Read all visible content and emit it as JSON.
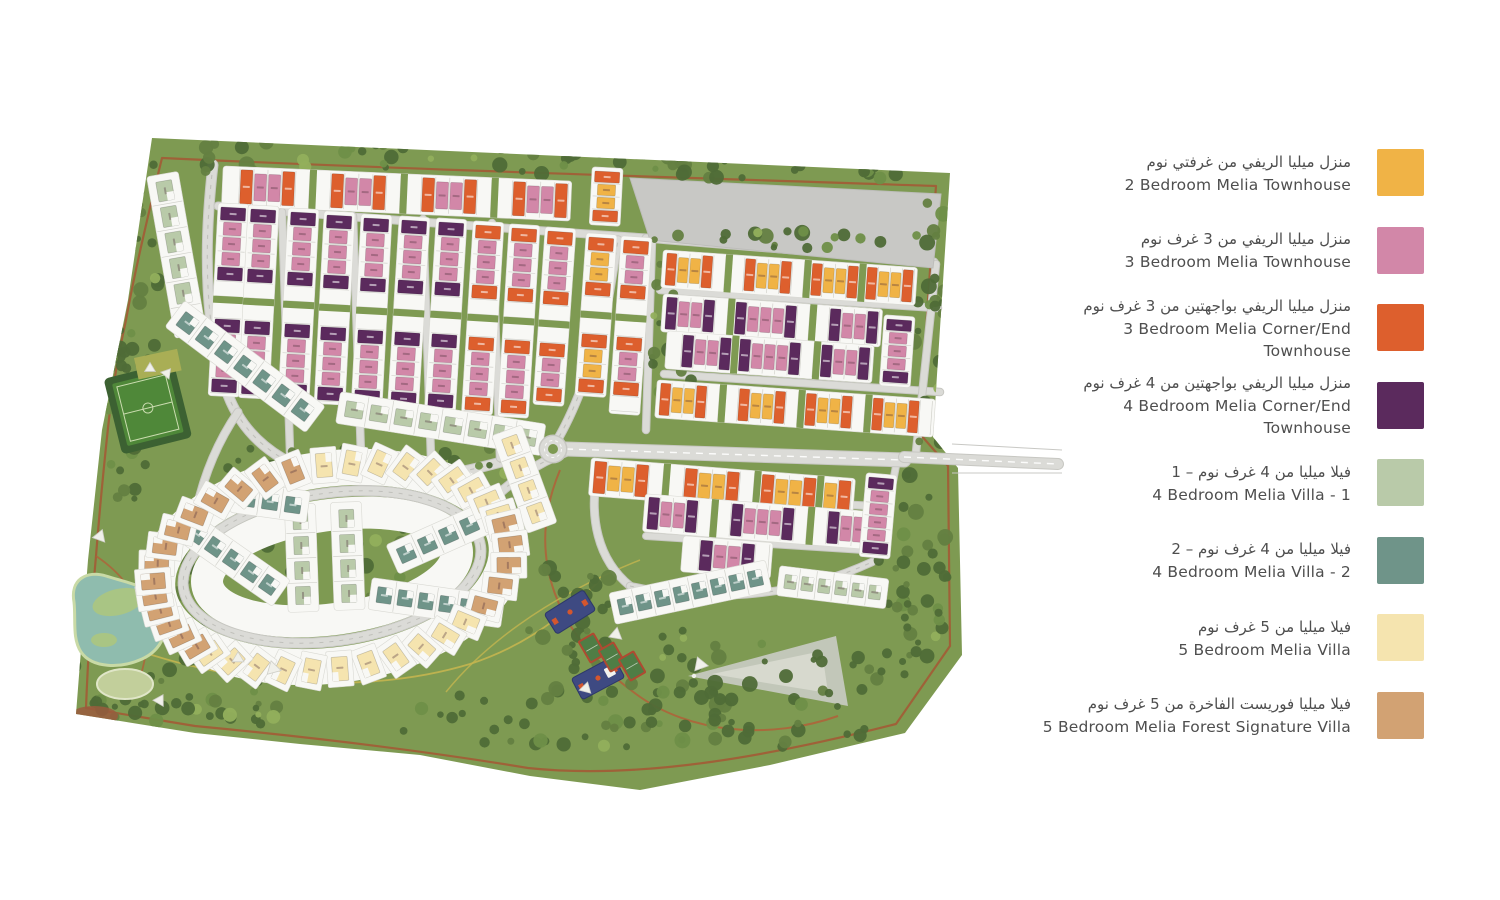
{
  "legend": {
    "items": [
      {
        "code": "Y",
        "ar": "منزل ميليا الريفي من غرفتي نوم",
        "en": "2 Bedroom Melia Townhouse",
        "color": "#F0B346"
      },
      {
        "code": "P",
        "ar": "منزل ميليا الريفي من 3 غرف نوم",
        "en": "3 Bedroom Melia Townhouse",
        "color": "#D287A8"
      },
      {
        "code": "O",
        "ar": "منزل ميليا الريفي بواجهتين من 3 غرف نوم",
        "en": "3 Bedroom Melia Corner/End Townhouse",
        "color": "#DD5F2D"
      },
      {
        "code": "U",
        "ar": "منزل ميليا الريفي بواجهتين من 4 غرف نوم",
        "en": "4 Bedroom Melia Corner/End Townhouse",
        "color": "#5B2A5D"
      },
      {
        "code": "G",
        "ar": "فيلا ميليا من 4 غرف نوم – 1",
        "en": "4 Bedroom Melia Villa - 1",
        "color": "#B9CAA9"
      },
      {
        "code": "T",
        "ar": "فيلا ميليا من 4 غرف نوم – 2",
        "en": "4 Bedroom Melia Villa - 2",
        "color": "#6F9489"
      },
      {
        "code": "C",
        "ar": "فيلا ميليا من 5 غرف نوم",
        "en": "5 Bedroom Melia Villa",
        "color": "#F5E4AF"
      },
      {
        "code": "N",
        "ar": "فيلا ميليا فوريست الفاخرة من 5 غرف نوم",
        "en": "5 Bedroom Melia Forest Signature Villa",
        "color": "#D2A273"
      }
    ]
  },
  "map": {
    "colors": {
      "base": "#7E9A52",
      "treeDark": "#4F6B37",
      "treeMid": "#647F41",
      "treeMid2": "#6F8F48",
      "treeLight": "#92AF5C",
      "road": "#DBDBD7",
      "roadEdge": "#C7C7C2",
      "dashGray": "#C0C0BB",
      "plot": "#F8F8F5",
      "plotEdge": "#D9D9D3",
      "div": "#D2D2CC",
      "water": "#8FBCAE",
      "waterEdge": "#C9DAA6",
      "island": "#A9C584",
      "lawn": "#C2CF9B",
      "lawnEdge": "#E0E6C8",
      "pitchDark": "#3C6132",
      "pitchField": "#4F8839",
      "pitchLine": "#CBDCB0",
      "olive": "#A9AE55",
      "navy": "#3E4A82",
      "navyEdge": "#2D3869",
      "accentOrange": "#D4562E",
      "court": "#4F7D45",
      "courtEdge": "#AF4A31",
      "gray1": "#C8C8C5",
      "gray2": "#C2C7B9",
      "gray3": "#D7D9CE",
      "redPatch": "#9A5B3D",
      "trailBrown": "#A35B35",
      "trailRed": "#B06038",
      "trailYellow": "#C4B54F"
    },
    "site": "152,138 950,173 933,437 958,468 962,655 905,733 770,765 640,790 530,776 420,755 300,744 195,733 76,714 88,560 102,430 128,300",
    "roundabout": {
      "x": 553,
      "y": 449,
      "r": 13
    },
    "oval": {
      "cx": 332,
      "cy": 567,
      "rx": 150,
      "ry": 74,
      "rot": -8
    },
    "gray_plots": {
      "main": "630,178 941,194 933,268 650,240",
      "tri": "688,676 836,636 848,706",
      "tri_inner": "712,674 822,651 828,693"
    },
    "lake": {
      "path": "M74,602 C70,580 86,570 106,576 C132,584 158,588 164,608 C170,630 162,650 142,659 C120,669 92,668 81,652 C72,638 76,620 74,602 Z",
      "islands": [
        [
          118,
          602,
          26,
          13,
          -14
        ],
        [
          104,
          640,
          13,
          7,
          0
        ]
      ]
    },
    "lawn": [
      125,
      684,
      28,
      15
    ],
    "red_patch": [
      94,
      716,
      24,
      10
    ],
    "pitch": {
      "x": 112,
      "y": 384,
      "w": 58,
      "h": 64,
      "rot": -14
    },
    "olive": {
      "x": 134,
      "y": 358,
      "w": 44,
      "h": 22,
      "rot": -12
    },
    "roads": [
      {
        "d": "M213,165 C203,250 205,335 228,395 C250,452 306,478 360,480 C430,483 478,468 524,456",
        "w": 9,
        "dash": "gray"
      },
      {
        "d": "M218,206 C360,218 500,228 646,238",
        "w": 7
      },
      {
        "d": "M646,238 C740,246 850,254 934,262",
        "w": 7,
        "dash": "gray"
      },
      {
        "d": "M282,212 L290,452",
        "w": 6.5
      },
      {
        "d": "M353,216 L361,455",
        "w": 6.5
      },
      {
        "d": "M423,219 L431,458",
        "w": 6.5
      },
      {
        "d": "M492,223 L500,458",
        "w": 6.5
      },
      {
        "d": "M660,290 L938,308",
        "w": 6.5
      },
      {
        "d": "M664,374 L940,392",
        "w": 6.5
      },
      {
        "d": "M652,240 L646,430",
        "w": 6.5
      },
      {
        "d": "M936,264 L916,452",
        "w": 6.5
      },
      {
        "d": "M559,437 C580,400 598,345 608,300 C613,272 616,252 618,240",
        "w": 7.5,
        "dash": "gray"
      },
      {
        "d": "M598,468 C588,518 598,560 630,586",
        "w": 7
      },
      {
        "d": "M600,492 L872,506",
        "w": 6.5
      },
      {
        "d": "M646,536 L864,550",
        "w": 6
      },
      {
        "d": "M896,466 L878,560",
        "w": 6
      },
      {
        "d": "M630,586 C700,602 790,600 872,562",
        "w": 6.5,
        "dash": "gray"
      },
      {
        "d": "M478,514 C512,478 540,462 566,452",
        "w": 8,
        "dash": "gray"
      },
      {
        "d": "M238,412 C212,450 198,492 192,534",
        "w": 7
      },
      {
        "d": "M566,449 L904,460",
        "w": 13,
        "dash": "white"
      },
      {
        "d": "M904,457 L1058,464",
        "w": 10,
        "dash": "white"
      }
    ],
    "entrance_lines": [
      "M952,444 L1062,450",
      "M952,473 L1062,473"
    ],
    "trails": [
      {
        "d": "M162,158 C420,170 700,178 936,186 C930,270 924,350 920,434 L948,466 L950,646 L896,724 C770,756 640,780 528,768 C420,750 300,736 195,726 L86,708 C88,655 92,600 96,556 C100,505 104,465 108,428 C112,390 118,356 126,320 C134,275 148,215 162,158 Z",
        "c": "trailBrown",
        "w": 2.2,
        "o": 0.9
      },
      {
        "d": "M560,470 C524,556 556,636 636,694 C690,734 770,740 838,716",
        "c": "trailRed",
        "w": 2,
        "o": 0.85
      },
      {
        "d": "M86,630 C200,682 350,700 470,664 C520,648 560,620 600,580",
        "c": "trailYellow",
        "w": 1.8,
        "o": 0.9
      },
      {
        "d": "M446,692 C480,650 540,600 640,560",
        "c": "trailYellow",
        "w": 1.5,
        "o": 0.8
      },
      {
        "d": "M96,556 C150,592 160,650 128,702",
        "c": "trailRed",
        "w": 1.8,
        "o": 0.8
      }
    ],
    "tree_zones": [
      [
        150,
        142,
        780,
        32,
        60
      ],
      [
        108,
        182,
        52,
        230,
        34
      ],
      [
        80,
        345,
        80,
        165,
        24
      ],
      [
        52,
        540,
        30,
        160,
        10
      ],
      [
        176,
        556,
        36,
        105,
        12
      ],
      [
        92,
        696,
        118,
        26,
        14
      ],
      [
        150,
        648,
        130,
        78,
        28
      ],
      [
        210,
        448,
        320,
        34,
        28
      ],
      [
        652,
        252,
        46,
        168,
        16
      ],
      [
        525,
        560,
        85,
        112,
        20
      ],
      [
        545,
        606,
        180,
        128,
        38
      ],
      [
        400,
        695,
        470,
        52,
        46
      ],
      [
        640,
        640,
        240,
        68,
        26
      ],
      [
        912,
        198,
        34,
        250,
        22
      ],
      [
        898,
        462,
        54,
        206,
        26
      ],
      [
        648,
        228,
        290,
        20,
        20
      ],
      [
        622,
        160,
        320,
        18,
        14
      ],
      [
        250,
        525,
        168,
        72,
        13
      ],
      [
        868,
        560,
        80,
        120,
        18
      ]
    ],
    "clusters": [
      {
        "k": "s",
        "x": 226,
        "y": 170,
        "d": "h",
        "r": 2.5,
        "u": 14,
        "dp": 32,
        "p": "wOPPOw.wOPPOw.wOPPOw.wOPPO"
      },
      {
        "k": "s",
        "x": 222,
        "y": 206,
        "d": "v",
        "r": 3,
        "u": 15,
        "dp": 23,
        "p": "UPPPUw.wUPPPU"
      },
      {
        "k": "s",
        "x": 252,
        "y": 208,
        "d": "v",
        "r": 3,
        "u": 15,
        "dp": 23,
        "p": "UPPPUw.wUPPPU"
      },
      {
        "k": "s",
        "x": 292,
        "y": 211,
        "d": "v",
        "r": 3,
        "u": 15,
        "dp": 23,
        "p": "UPPPUw.wUPPPU"
      },
      {
        "k": "s",
        "x": 328,
        "y": 214,
        "d": "v",
        "r": 3,
        "u": 15,
        "dp": 23,
        "p": "UPPPUw.wUPPPU"
      },
      {
        "k": "s",
        "x": 365,
        "y": 217,
        "d": "v",
        "r": 3,
        "u": 15,
        "dp": 23,
        "p": "UPPPUw.wUPPPU"
      },
      {
        "k": "s",
        "x": 403,
        "y": 219,
        "d": "v",
        "r": 3.5,
        "u": 15,
        "dp": 23,
        "p": "UPPPUw.wUPPPU"
      },
      {
        "k": "s",
        "x": 440,
        "y": 221,
        "d": "v",
        "r": 3.5,
        "u": 15,
        "dp": 23,
        "p": "UPPPUw.wUPPPU"
      },
      {
        "k": "s",
        "x": 477,
        "y": 224,
        "d": "v",
        "r": 3.5,
        "u": 15,
        "dp": 23,
        "p": "OPPPOw.wOPPPO"
      },
      {
        "k": "s",
        "x": 513,
        "y": 227,
        "d": "v",
        "r": 3.5,
        "u": 15,
        "dp": 23,
        "p": "OPPPOw.wOPPPO"
      },
      {
        "k": "s",
        "x": 549,
        "y": 230,
        "d": "v",
        "r": 4,
        "u": 15,
        "dp": 23,
        "p": "OPPPOw.wOPPO"
      },
      {
        "k": "s",
        "x": 596,
        "y": 170,
        "d": "v",
        "r": 3,
        "u": 13,
        "dp": 23,
        "p": "OYYO"
      },
      {
        "k": "s",
        "x": 590,
        "y": 236,
        "d": "v",
        "r": 4,
        "u": 15,
        "dp": 23,
        "p": "OYYOw.wOYYO"
      },
      {
        "k": "s",
        "x": 625,
        "y": 239,
        "d": "v",
        "r": 4,
        "u": 15,
        "dp": 23,
        "p": "OPPOw.wOPPOw"
      },
      {
        "k": "s",
        "x": 666,
        "y": 254,
        "d": "h",
        "r": 4,
        "u": 12,
        "dp": 30,
        "p": "OYYOw.wOYYOw.OYYO.OYYO"
      },
      {
        "k": "s",
        "x": 666,
        "y": 298,
        "d": "h",
        "r": 4,
        "u": 12.5,
        "dp": 30,
        "p": "UPPUw.UPPPUw.wUPPU"
      },
      {
        "k": "s",
        "x": 670,
        "y": 335,
        "d": "h",
        "r": 4,
        "u": 12.5,
        "dp": 30,
        "p": "wUPPU.UPPPUw.UPPU"
      },
      {
        "k": "s",
        "x": 660,
        "y": 384,
        "d": "h",
        "r": 4,
        "u": 12,
        "dp": 30,
        "p": "OYYOw.wOYYOw.OYYOw.OYYOw"
      },
      {
        "k": "s",
        "x": 888,
        "y": 318,
        "d": "v",
        "r": 4,
        "u": 13,
        "dp": 23,
        "p": "UPPPU"
      },
      {
        "k": "s",
        "x": 594,
        "y": 462,
        "d": "h",
        "r": 4.5,
        "u": 14,
        "dp": 30,
        "p": "OYYOw.wOYYOw.OYYO.YO"
      },
      {
        "k": "s",
        "x": 648,
        "y": 498,
        "d": "h",
        "r": 4.5,
        "u": 12.8,
        "dp": 30,
        "p": "UPPUw.wUPPPUw.wUPPU"
      },
      {
        "k": "s",
        "x": 686,
        "y": 540,
        "d": "h",
        "r": 4.5,
        "u": 14,
        "dp": 28,
        "p": "wUPPUw"
      },
      {
        "k": "s",
        "x": 870,
        "y": 476,
        "d": "v",
        "r": 5,
        "u": 13,
        "dp": 23,
        "p": "UPPPPU"
      },
      {
        "k": "v",
        "x": 163,
        "y": 178,
        "r": 80,
        "n": 6,
        "c": "G",
        "st": 26,
        "w": 20,
        "h": 16
      },
      {
        "k": "v",
        "x": 178,
        "y": 316,
        "r": 37,
        "n": 7,
        "c": "T",
        "st": 24,
        "w": 17,
        "h": 17
      },
      {
        "k": "v",
        "x": 342,
        "y": 408,
        "r": 9,
        "n": 8,
        "c": "G",
        "st": 25,
        "w": 18,
        "h": 16
      },
      {
        "k": "v",
        "x": 782,
        "y": 581,
        "r": 7,
        "n": 6,
        "c": "G",
        "st": 17,
        "w": 12,
        "h": 14
      },
      {
        "k": "v",
        "x": 616,
        "y": 608,
        "r": -12,
        "n": 8,
        "c": "T",
        "st": 19,
        "w": 14,
        "h": 16
      },
      {
        "k": "v",
        "x": 300,
        "y": 508,
        "r": 88,
        "n": 4,
        "c": "G",
        "st": 25,
        "w": 18,
        "h": 15
      },
      {
        "k": "v",
        "x": 346,
        "y": 506,
        "r": 88,
        "n": 4,
        "c": "G",
        "st": 25,
        "w": 18,
        "h": 15
      },
      {
        "k": "v",
        "x": 236,
        "y": 497,
        "r": 8,
        "n": 3,
        "c": "T",
        "st": 23,
        "w": 16,
        "h": 16
      },
      {
        "k": "v",
        "x": 188,
        "y": 528,
        "r": 35,
        "n": 5,
        "c": "T",
        "st": 22,
        "w": 16,
        "h": 16
      },
      {
        "k": "v",
        "x": 374,
        "y": 594,
        "r": 8,
        "n": 6,
        "c": "T",
        "st": 21,
        "w": 15,
        "h": 16
      },
      {
        "k": "v",
        "x": 396,
        "y": 558,
        "r": -24,
        "n": 4,
        "c": "T",
        "st": 23,
        "w": 16,
        "h": 16
      },
      {
        "k": "v",
        "x": 508,
        "y": 434,
        "r": 70,
        "n": 4,
        "c": "C",
        "st": 24,
        "w": 18,
        "h": 16
      },
      {
        "k": "r",
        "a0": 196,
        "a1": 262,
        "n": 8,
        "c": "N"
      },
      {
        "k": "r",
        "a0": 272,
        "a1": 344,
        "n": 9,
        "c": "C"
      },
      {
        "k": "r",
        "a0": 350,
        "a1": 396,
        "n": 5,
        "c": "N"
      },
      {
        "k": "r",
        "a0": 46,
        "a1": 138,
        "n": 11,
        "c": "C"
      },
      {
        "k": "r",
        "a0": 144,
        "a1": 186,
        "n": 6,
        "c": "N"
      }
    ],
    "playground": {
      "navy": [
        [
          570,
          612,
          46,
          24,
          -32,
          0
        ],
        [
          598,
          678,
          48,
          24,
          -28,
          1
        ]
      ],
      "tennis": [
        [
          592,
          648
        ],
        [
          612,
          657
        ],
        [
          632,
          666
        ]
      ],
      "tw": 17,
      "th": 24,
      "trot": -30
    },
    "sails": [
      [
        100,
        536,
        11,
        20
      ],
      [
        273,
        668,
        12,
        -15
      ],
      [
        160,
        700,
        10,
        30
      ],
      [
        150,
        368,
        9,
        0
      ],
      [
        167,
        373,
        9,
        40
      ],
      [
        616,
        634,
        11,
        10
      ],
      [
        700,
        664,
        12,
        -20
      ],
      [
        586,
        688,
        10,
        15
      ],
      [
        238,
        658,
        10,
        0
      ]
    ]
  }
}
